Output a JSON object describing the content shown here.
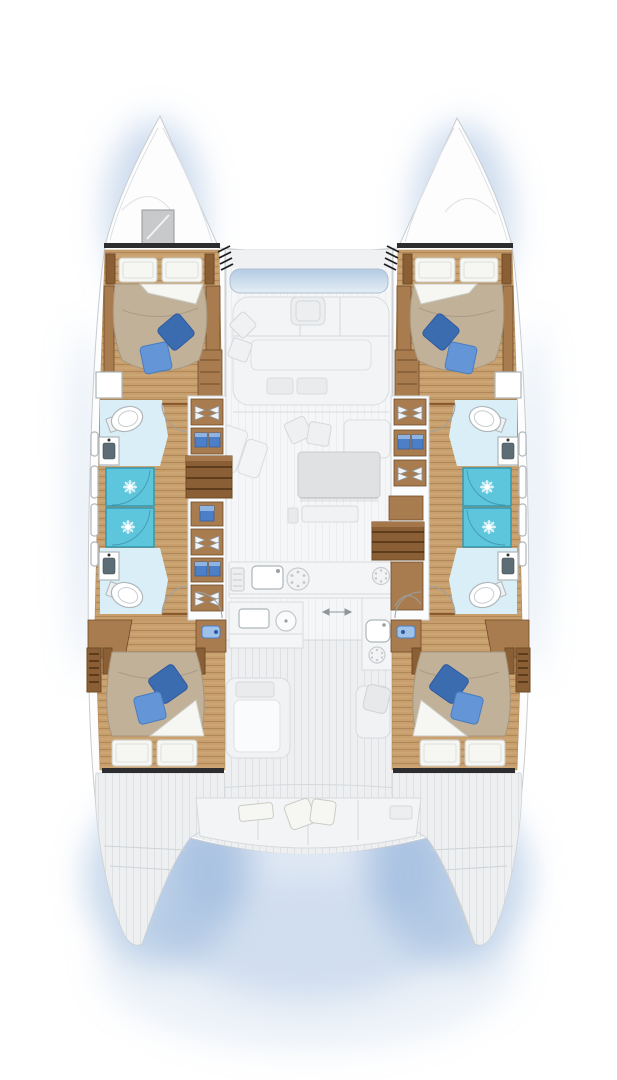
{
  "page": {
    "kind": "catamaran-deck-plan"
  },
  "colors": {
    "hull-fill": "#fdfdfe",
    "hull-line": "#c8ccd0",
    "glow": "#9dbade",
    "deck": "#edeff1",
    "deck-line": "#d6d9dc",
    "salon-floor": "#f5f6f7",
    "bulkhead": "#2d2d2f",
    "wood": "#c89f6c",
    "wood-mid": "#a87c4f",
    "wood-dark": "#8a5f35",
    "wood-edge": "#6f4b27",
    "bed": "#c2b199",
    "bed-line": "#a59681",
    "linen": "#f6f6f3",
    "linen-line": "#cbcbc5",
    "pillow-dark": "#3c6cb0",
    "pillow-dark-line": "#2d59a0",
    "pillow-light": "#6495d6",
    "pillow-light-line": "#477dc0",
    "shower": "#5dc6dc",
    "shower-line": "#2f96b0",
    "bath": "#d9eef6",
    "fixture-line": "#aeb6ba",
    "sink-dark": "#5d6d75",
    "storage-blue": "#4c7fc7",
    "storage-blue-light": "#8fb4e2",
    "sofa": "#f3f4f6",
    "sofa-line": "#d9dcdf",
    "table": "#dfe1e3",
    "table-line": "#c9ccd0",
    "window-blue-1": "#b4cbe3",
    "window-blue-2": "#e4edf5",
    "hatch": "#c7c9cb",
    "hatch-line": "#96989a",
    "arc": "#9aa0a4"
  },
  "icons": {
    "shower-head": "starburst",
    "stove-burner": "circle-with-dots",
    "toilet": "oval-bowl",
    "sink": "basin-with-tap",
    "door-swing": "quarter-arc",
    "sliding-door": "double-arrow",
    "deck-hatch": "gray-square",
    "glass-rack": "stemware-pair",
    "storage-bin": "blue-box"
  }
}
